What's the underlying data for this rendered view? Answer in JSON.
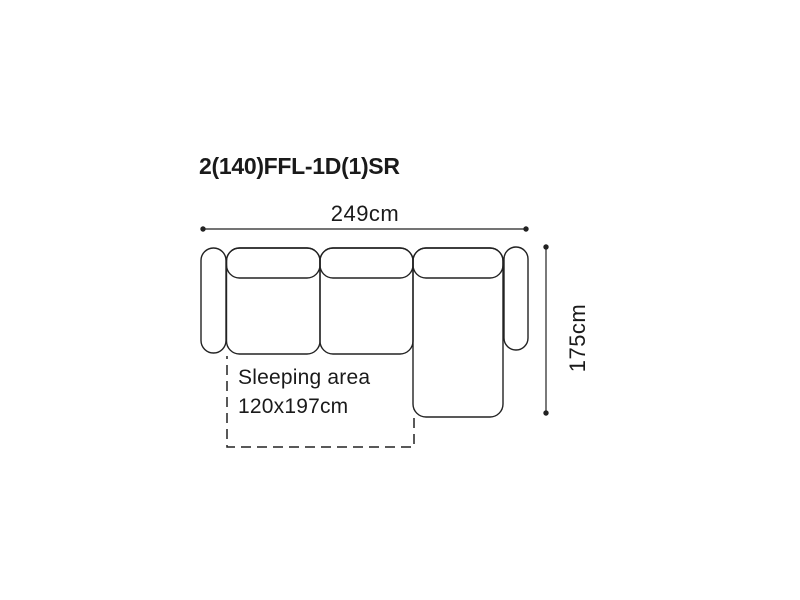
{
  "diagram": {
    "title": "2(140)FFL-1D(1)SR",
    "width_dimension_label": "249cm",
    "height_dimension_label": "175cm",
    "sleeping_area": {
      "label": "Sleeping area",
      "size": "120x197cm"
    },
    "colors": {
      "outline": "#222222",
      "text": "#1a1a1a",
      "background": "#ffffff"
    }
  }
}
